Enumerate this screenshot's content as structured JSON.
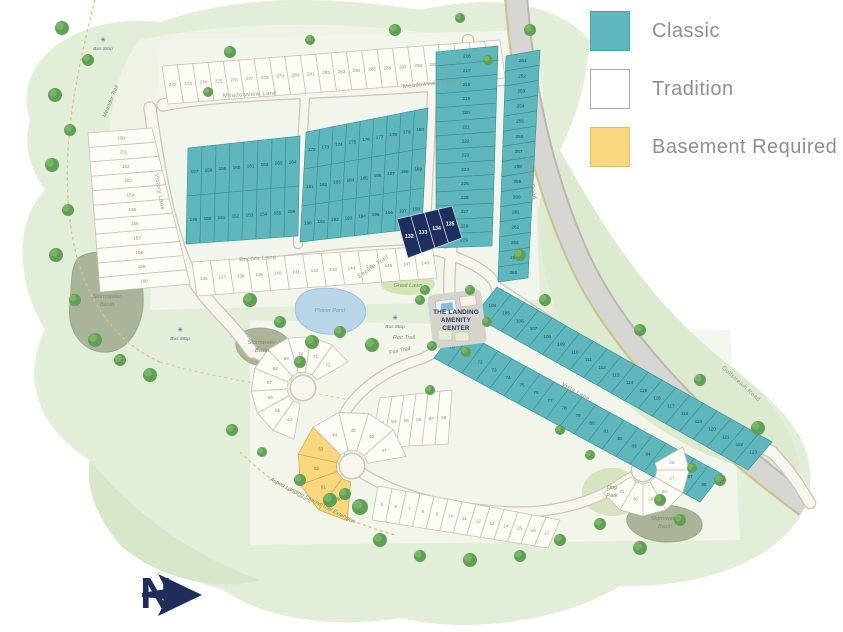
{
  "legend": {
    "items": [
      {
        "label": "Classic",
        "color": "#5fb7bc"
      },
      {
        "label": "Tradition",
        "color": "#ffffff"
      },
      {
        "label": "Basement Required",
        "color": "#f8d77e"
      }
    ]
  },
  "compass": {
    "north_label": "N"
  },
  "map": {
    "labels": {
      "amenity_line1": "THE LANDING",
      "amenity_line2": "AMENITY",
      "amenity_line3": "CENTER",
      "great_lawn": "Great Lawn",
      "pond": "Plover Pond",
      "basin_line1": "Stormwater",
      "basin_line2": "Basin",
      "bus_stop": "Bus Stop",
      "dog_park_line1": "Dog",
      "dog_park_line2": "Park",
      "rec_trail": "Rec Trail",
      "fox_trail": "Fox Trail"
    },
    "streets": {
      "meadowview": "Meadowview Lane",
      "victory": "Victory Lane",
      "encore": "Encore Lane",
      "encore_trail": "Encore Trail",
      "vista": "Vista Lane",
      "gulfstream": "Gulfstream Road",
      "meander": "Meander Trail",
      "aspen": "Aspen Landing Shared Trail Extension"
    },
    "highlighted_lots": [
      "132",
      "133",
      "134",
      "135"
    ],
    "basement_lots": [
      "60",
      "61",
      "62",
      "63"
    ],
    "lot_ranges": {
      "top_row": [
        272,
        293
      ],
      "left_col": [
        150,
        160
      ],
      "teal_a1": [
        157,
        164
      ],
      "teal_a2": [
        149,
        156
      ],
      "teal_b1": [
        172,
        180
      ],
      "teal_b2": [
        181,
        189
      ],
      "teal_b3": [
        190,
        198
      ],
      "teal_c": [
        216,
        229
      ],
      "teal_r": [
        251,
        265
      ],
      "encore_row": [
        136,
        148
      ],
      "navy": [
        132,
        135
      ],
      "vista_ne": [
        104,
        123
      ],
      "vista_sw": [
        70,
        88
      ],
      "bottom_row": [
        5,
        17
      ],
      "mid_block": [
        53,
        58
      ],
      "fan1": [
        64,
        72
      ],
      "fan2_yellow": [
        60,
        63
      ],
      "fan2_white": [
        44,
        47
      ],
      "fan3": [
        26,
        31
      ]
    }
  }
}
